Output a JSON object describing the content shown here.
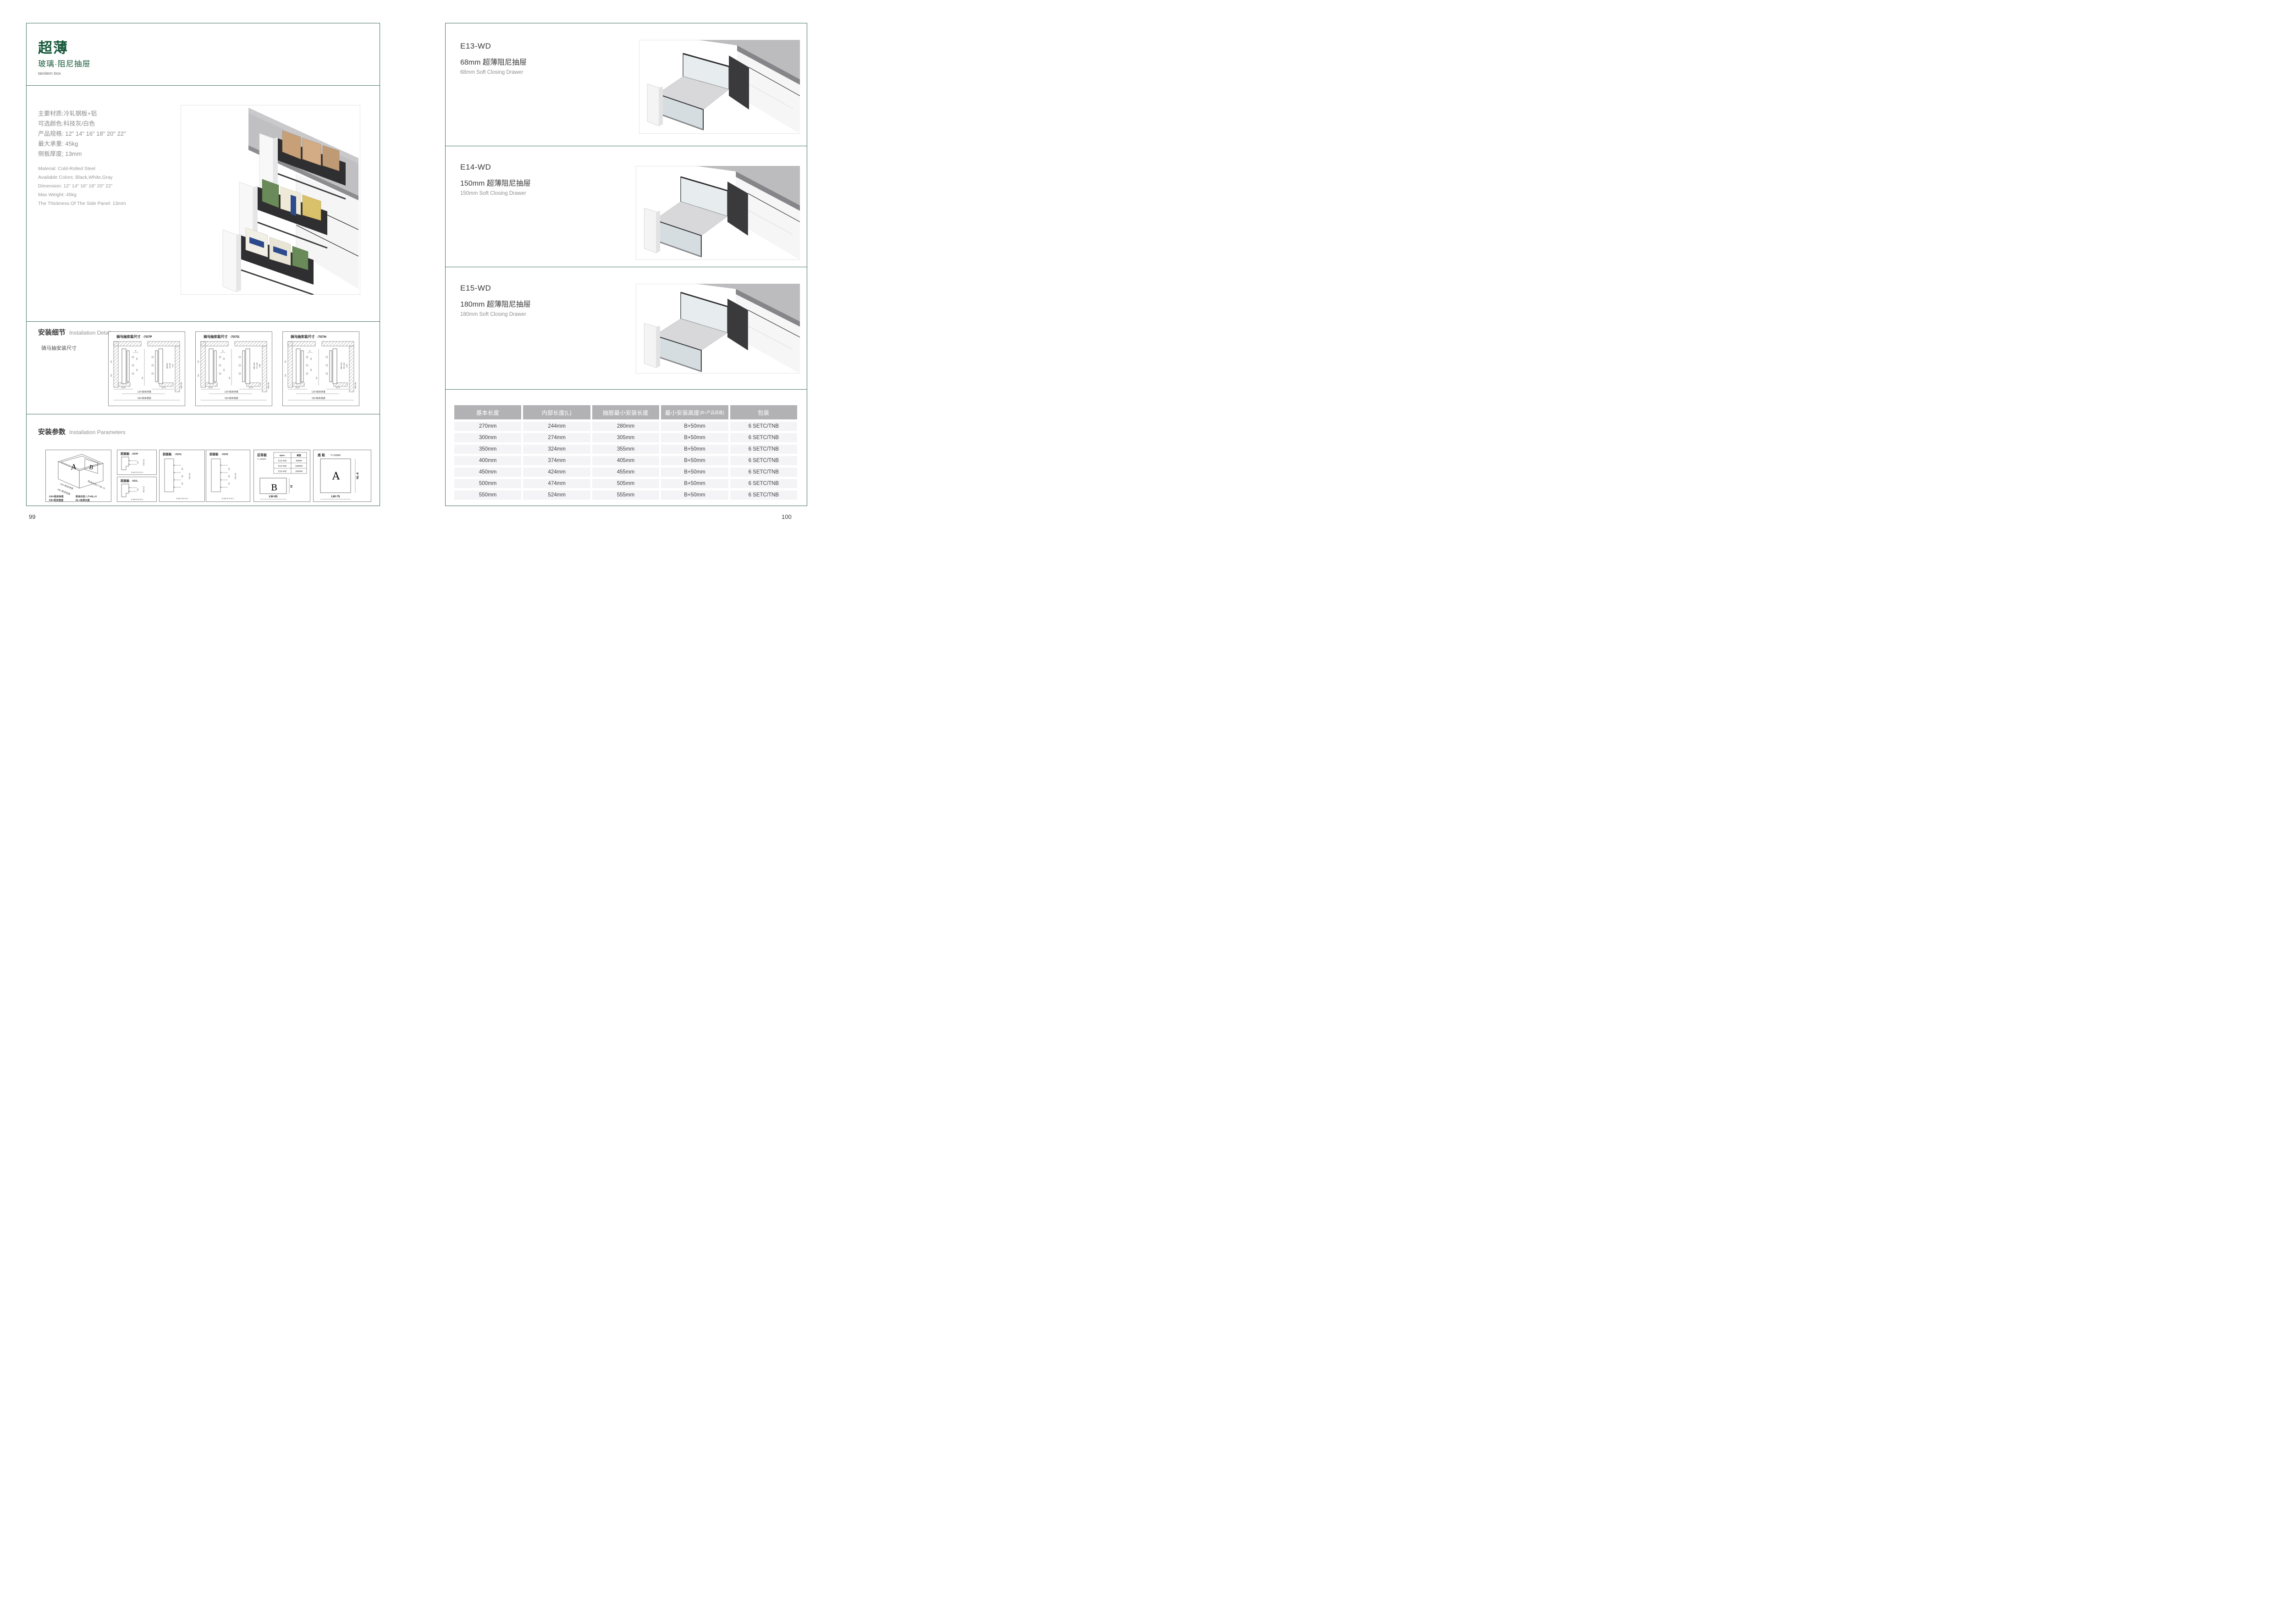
{
  "left_page": {
    "title": "超薄",
    "subtitle": "玻璃·阻尼抽屉",
    "tagline": "tandem box",
    "specs_cn": [
      "主要材质:冷轧钢板+铝",
      "可选颜色:科技灰/白色",
      "产品规格: 12\" 14\" 16\" 18\" 20\" 22\"",
      "最大承重: 45kg",
      "侧板厚度; 13mm"
    ],
    "specs_en": [
      "Material: Cold-Rolled Steel",
      "Available Colors: Black,White,Gray",
      "Dimension: 12\" 14\" 16\" 18\" 20\" 22\"",
      "Max Weight: 45kg",
      "The Thickness Of The Side Panel: 13mm"
    ],
    "install_details": {
      "heading_cn": "安装细节",
      "heading_en": "Installation Details",
      "subheading": "骑马抽安装尺寸",
      "panels": [
        {
          "title": "骑马抽安装尺寸",
          "model": "-707P",
          "dims": {
            "top": "9",
            "a": "20",
            "b": "32",
            "center": "16",
            "left": [
              "32",
              "54"
            ],
            "right": [
              "Min82",
              "91.50",
              "113"
            ],
            "bottom": [
              "16.5",
              "37.5"
            ],
            "min": "Min 36"
          },
          "labels": {
            "lw": "LW=柜体净宽",
            "kb": "KB=柜体宽度"
          }
        },
        {
          "title": "骑马抽安装尺寸",
          "model": "-707G",
          "dims": {
            "top": "9",
            "a": "20",
            "b": "32",
            "center": "16",
            "left": [
              "32",
              "64"
            ],
            "right": [
              "Min162",
              "171.50",
              "195"
            ],
            "bottom": [
              "16.5",
              "37.5"
            ],
            "min": "Min 36"
          },
          "labels": {
            "lw": "LW=柜体净宽",
            "kb": "KB=柜体宽度"
          }
        },
        {
          "title": "骑马抽安装尺寸",
          "model": "-707H",
          "dims": {
            "top": "9",
            "a": "20",
            "b": "32",
            "center": "16",
            "left": [
              "32",
              "64"
            ],
            "right": [
              "Min192",
              "201.50",
              "225"
            ],
            "bottom": [
              "16.5",
              "37.5"
            ],
            "min": "Min 36"
          },
          "labels": {
            "lw": "LW=柜体净宽",
            "kb": "KB=柜体宽度"
          }
        }
      ]
    },
    "install_params": {
      "heading_cn": "安装参数",
      "heading_en": "Installation Parameters",
      "iso": {
        "letter_a": "A",
        "letter_b": "B",
        "diag_label": "柜体内空LT=NL+3",
        "lw_label": "LW=柜体净宽",
        "kb_label": "KB=柜体宽度",
        "legend": [
          "LW=柜体净宽",
          "柜体内空: LT=NL+3",
          "KB=柜体宽度",
          "NL=标准长度"
        ]
      },
      "front_panels": [
        {
          "title": "前面板",
          "model": "-707P",
          "dim": "32",
          "min": "min 54",
          "note": "2-ø2+0.2-0.1"
        },
        {
          "title": "前面板",
          "model": "-707L",
          "dim": "32",
          "min": "min 54",
          "note": "2-ø2+0.2-0.1"
        },
        {
          "title": "前面板",
          "model": "-707G",
          "dims": [
            "32",
            "64",
            "32"
          ],
          "min": "min 54",
          "note": "4-ø2+0.2-0.1"
        },
        {
          "title": "前面板",
          "model": "-707H",
          "dims": [
            "32",
            "64",
            "32"
          ],
          "min": "min 54",
          "note": "4-ø2+0.2-0.1"
        }
      ],
      "back_panel": {
        "title": "后背板",
        "thickness": "T=16MM",
        "table_headers": [
          "Spec.",
          "高度"
        ],
        "table_rows": [
          [
            "E13-WD",
            "68MM"
          ],
          [
            "E14-WD",
            "150MM"
          ],
          [
            "E15-WD",
            "180MM"
          ]
        ],
        "letter": "B",
        "height_label": "H",
        "width_label": "LW-85"
      },
      "bottom_panel": {
        "title": "底 板",
        "thickness": "T=16MM",
        "letter": "A",
        "length_label": "NL-6",
        "width_label": "LW-75"
      }
    },
    "page_number": "99"
  },
  "right_page": {
    "sections": [
      {
        "code": "E13-WD",
        "name_cn": "68mm 超薄阻尼抽屉",
        "name_en": "68mm Soft Closing Drawer"
      },
      {
        "code": "E14-WD",
        "name_cn": "150mm 超薄阻尼抽屉",
        "name_en": "150mm Soft Closing Drawer"
      },
      {
        "code": "E15-WD",
        "name_cn": "180mm 超薄阻尼抽屉",
        "name_en": "180mm Soft Closing Drawer"
      }
    ],
    "table": {
      "headers": [
        {
          "label": "基本长度"
        },
        {
          "label": "内部长度(L)"
        },
        {
          "label": "抽屉最小安装长度"
        },
        {
          "label": "最小安装高度",
          "sub": "(B=产品高度)"
        },
        {
          "label": "包装"
        }
      ],
      "rows": [
        [
          "270mm",
          "244mm",
          "280mm",
          "B+50mm",
          "6 SETC/TNB"
        ],
        [
          "300mm",
          "274mm",
          "305mm",
          "B+50mm",
          "6 SETC/TNB"
        ],
        [
          "350mm",
          "324mm",
          "355mm",
          "B+50mm",
          "6 SETC/TNB"
        ],
        [
          "400mm",
          "374mm",
          "405mm",
          "B+50mm",
          "6 SETC/TNB"
        ],
        [
          "450mm",
          "424mm",
          "455mm",
          "B+50mm",
          "6 SETC/TNB"
        ],
        [
          "500mm",
          "474mm",
          "505mm",
          "B+50mm",
          "6 SETC/TNB"
        ],
        [
          "550mm",
          "524mm",
          "555mm",
          "B+50mm",
          "6 SETC/TNB"
        ]
      ]
    },
    "page_number": "100"
  },
  "colors": {
    "accent_green": "#17593a",
    "border_green": "#406e58",
    "table_header_bg": "#b2b2b5",
    "table_row_bg": "#f4f4f6"
  }
}
